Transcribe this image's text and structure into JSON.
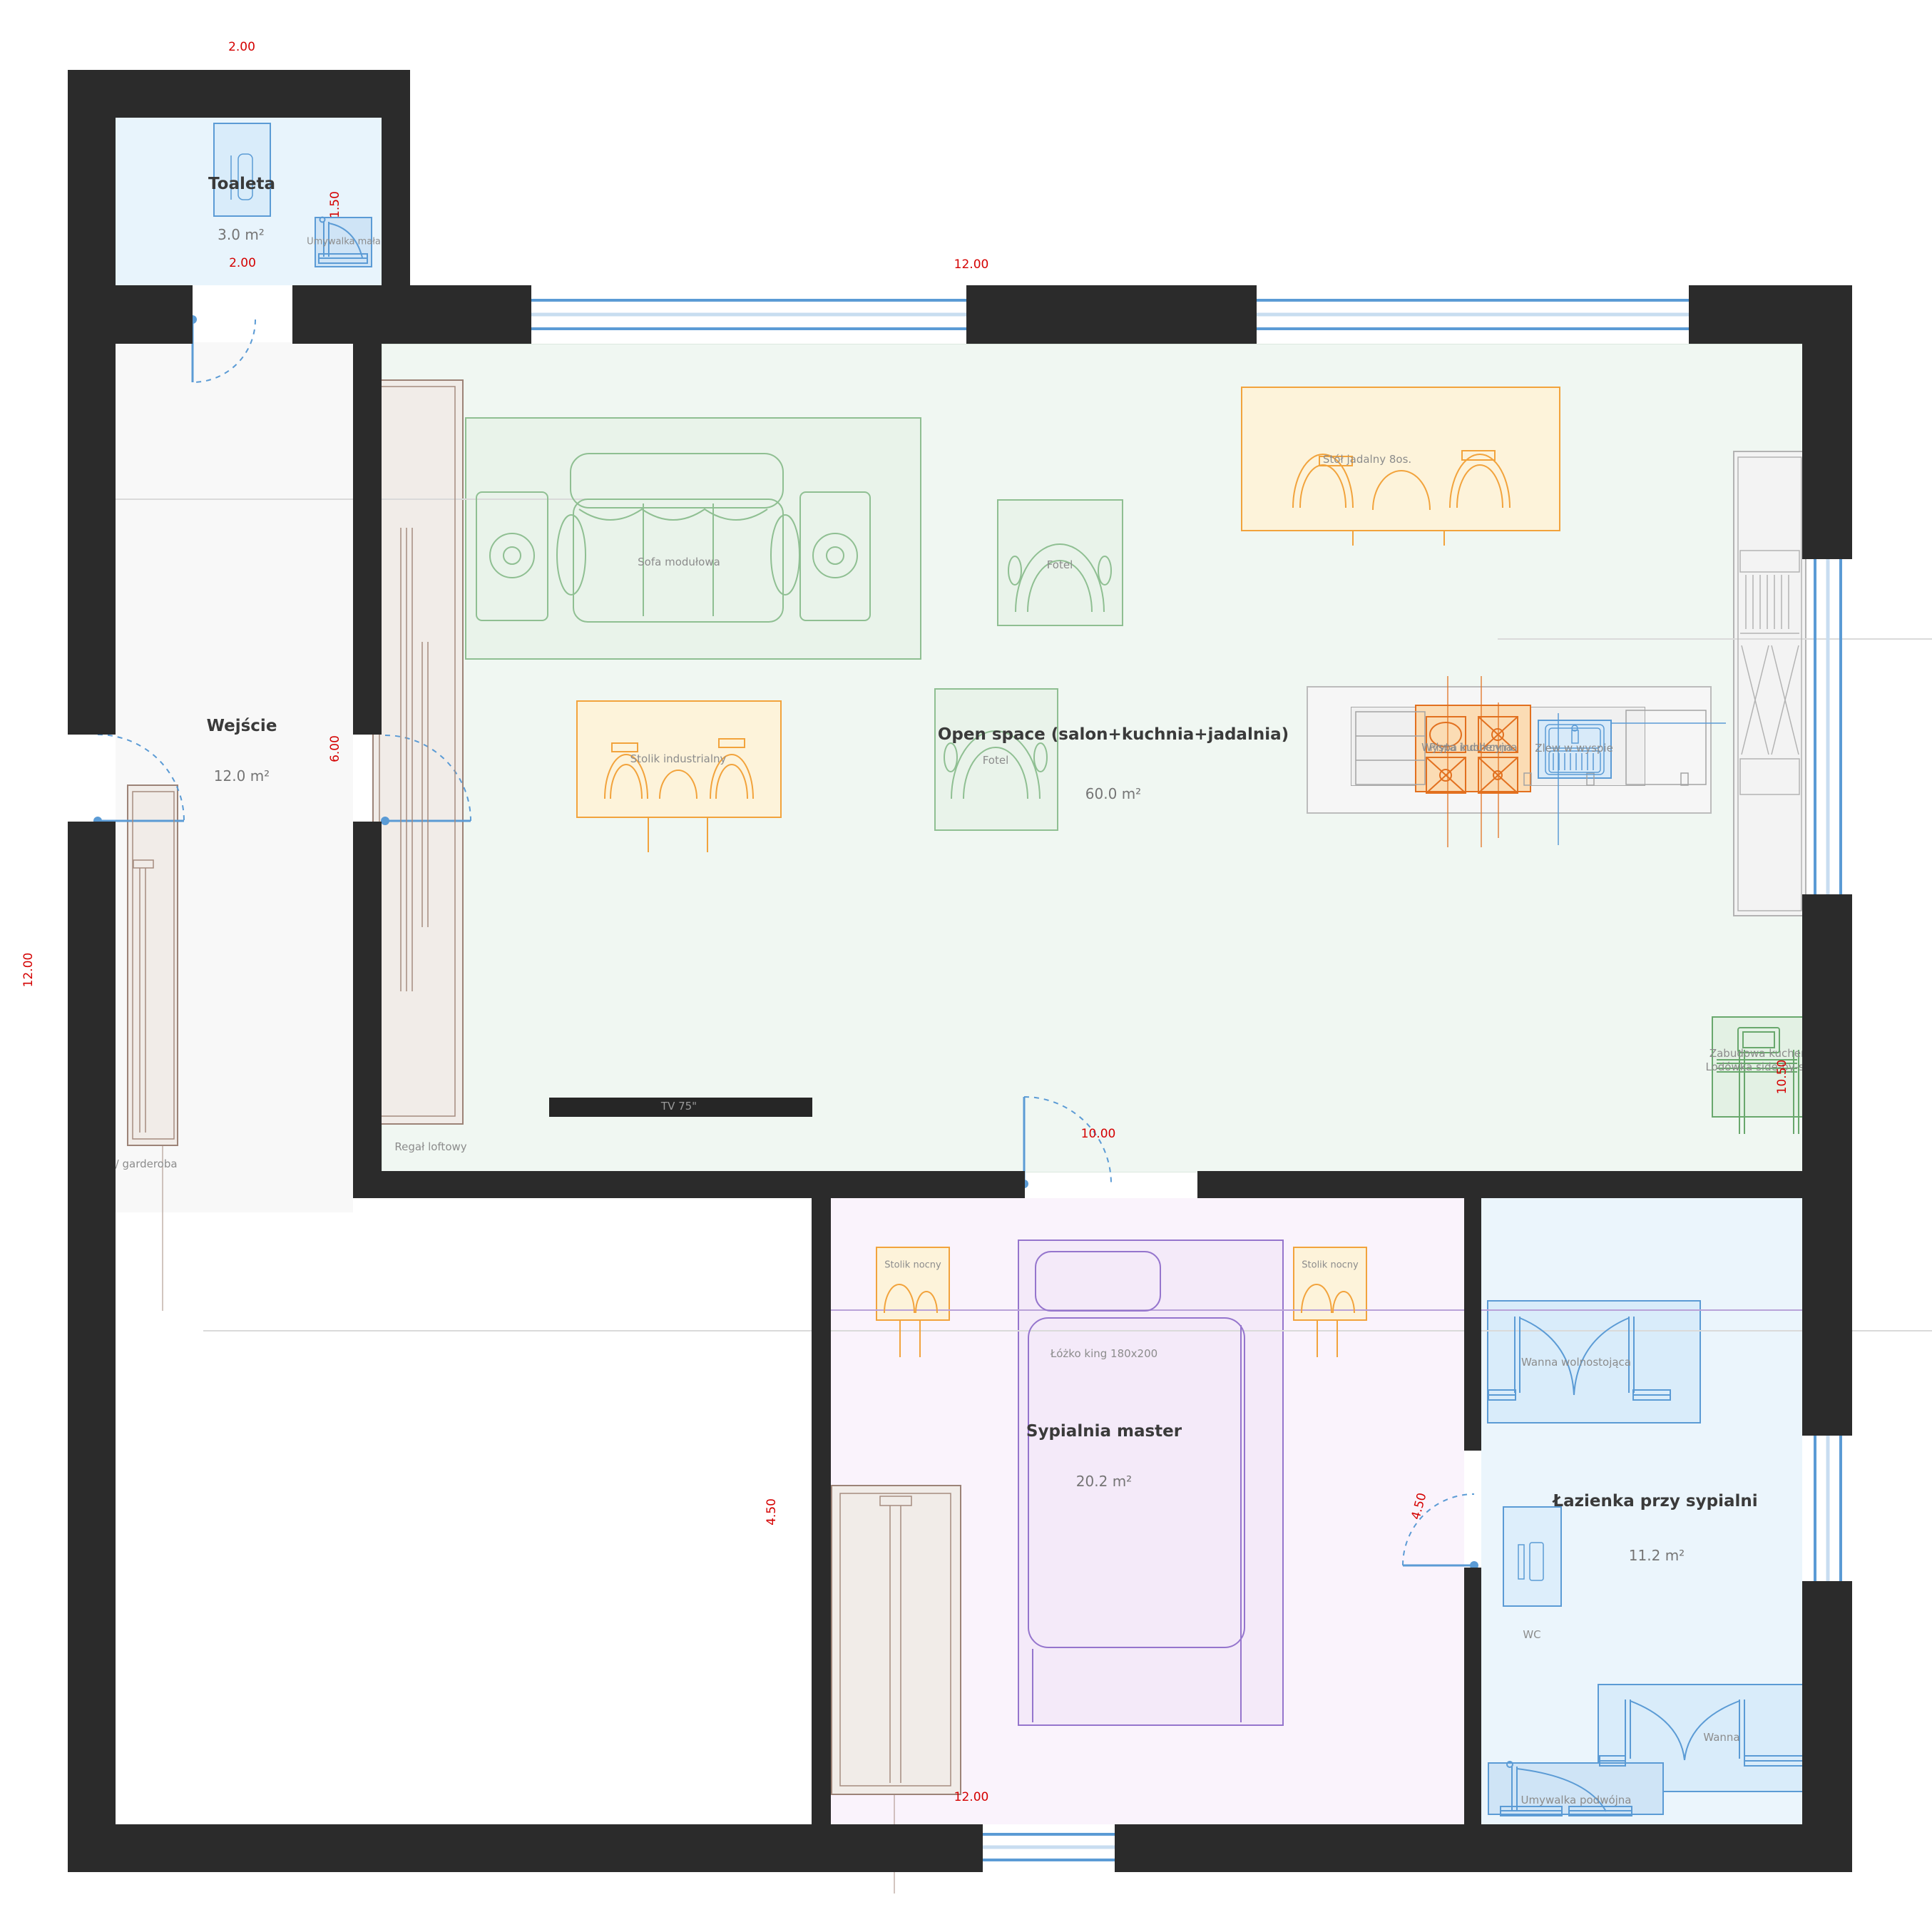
{
  "rooms": [
    {
      "name": "Toaleta",
      "area": "3.0 m²"
    },
    {
      "name": "Wejście",
      "area": "12.0 m²"
    },
    {
      "name": "Open space (salon+kuchnia+jadalnia)",
      "area": "60.0 m²"
    },
    {
      "name": "Sypialnia master",
      "area": "20.2 m²"
    },
    {
      "name": "Łazienka przy sypialni",
      "area": "11.2 m²"
    }
  ],
  "furniture": {
    "sofa": "Sofa modułowa",
    "armchair_top": "Fotel",
    "armchair_mid": "Fotel",
    "coffee_table": "Stolik industrialny",
    "dining_table": "Stół jadalny 8os.",
    "kitchen_island": "Wyspa kuchenna",
    "induction_hob": "Płyta indukcyjna",
    "island_sink": "Zlew w wyspie",
    "kitchen_built_in": "Zabudowa kuchenna",
    "fridge": "Lodówka side-by-side",
    "loft_shelf": "Regał loftowy",
    "tv": "TV 75\"",
    "coat_wardrobe": "Wieszak / garderoba",
    "nightstand_left": "Stolik nocny",
    "nightstand_right": "Stolik nocny",
    "bed": "Łóżko king 180x200",
    "freestanding_tub": "Wanna wolnostojąca",
    "toilet_wc": "WC",
    "bathtub": "Wanna",
    "double_washbasin": "Umywalka podwójna",
    "small_washbasin": "Umywalka mała"
  },
  "dimensions": {
    "toilet_top_width": "2.00",
    "toilet_depth": "1.50",
    "toilet_inner_width": "2.00",
    "top_width": "12.00",
    "entry_height": "6.00",
    "left_height": "12.00",
    "living_to_bedroom_door": "10.00",
    "kitchen_wall": "10.50",
    "bedroom_left": "4.50",
    "bedroom_bath_door": "4.50",
    "bottom_width": "12.00"
  },
  "colors": {
    "wall": "#2b2b2b",
    "dimension_text": "#d40000",
    "door_window": "#5b9bd5",
    "living_zone": "#f0f7f2",
    "bedroom_zone": "#faf3fc",
    "bath_zone": "#ebf5fc",
    "toilet_zone": "#e8f4fc",
    "accent_orange": "#f2a33c",
    "accent_deep_orange": "#e2701f",
    "accent_green": "#69a86d",
    "accent_purple": "#9575cd"
  }
}
